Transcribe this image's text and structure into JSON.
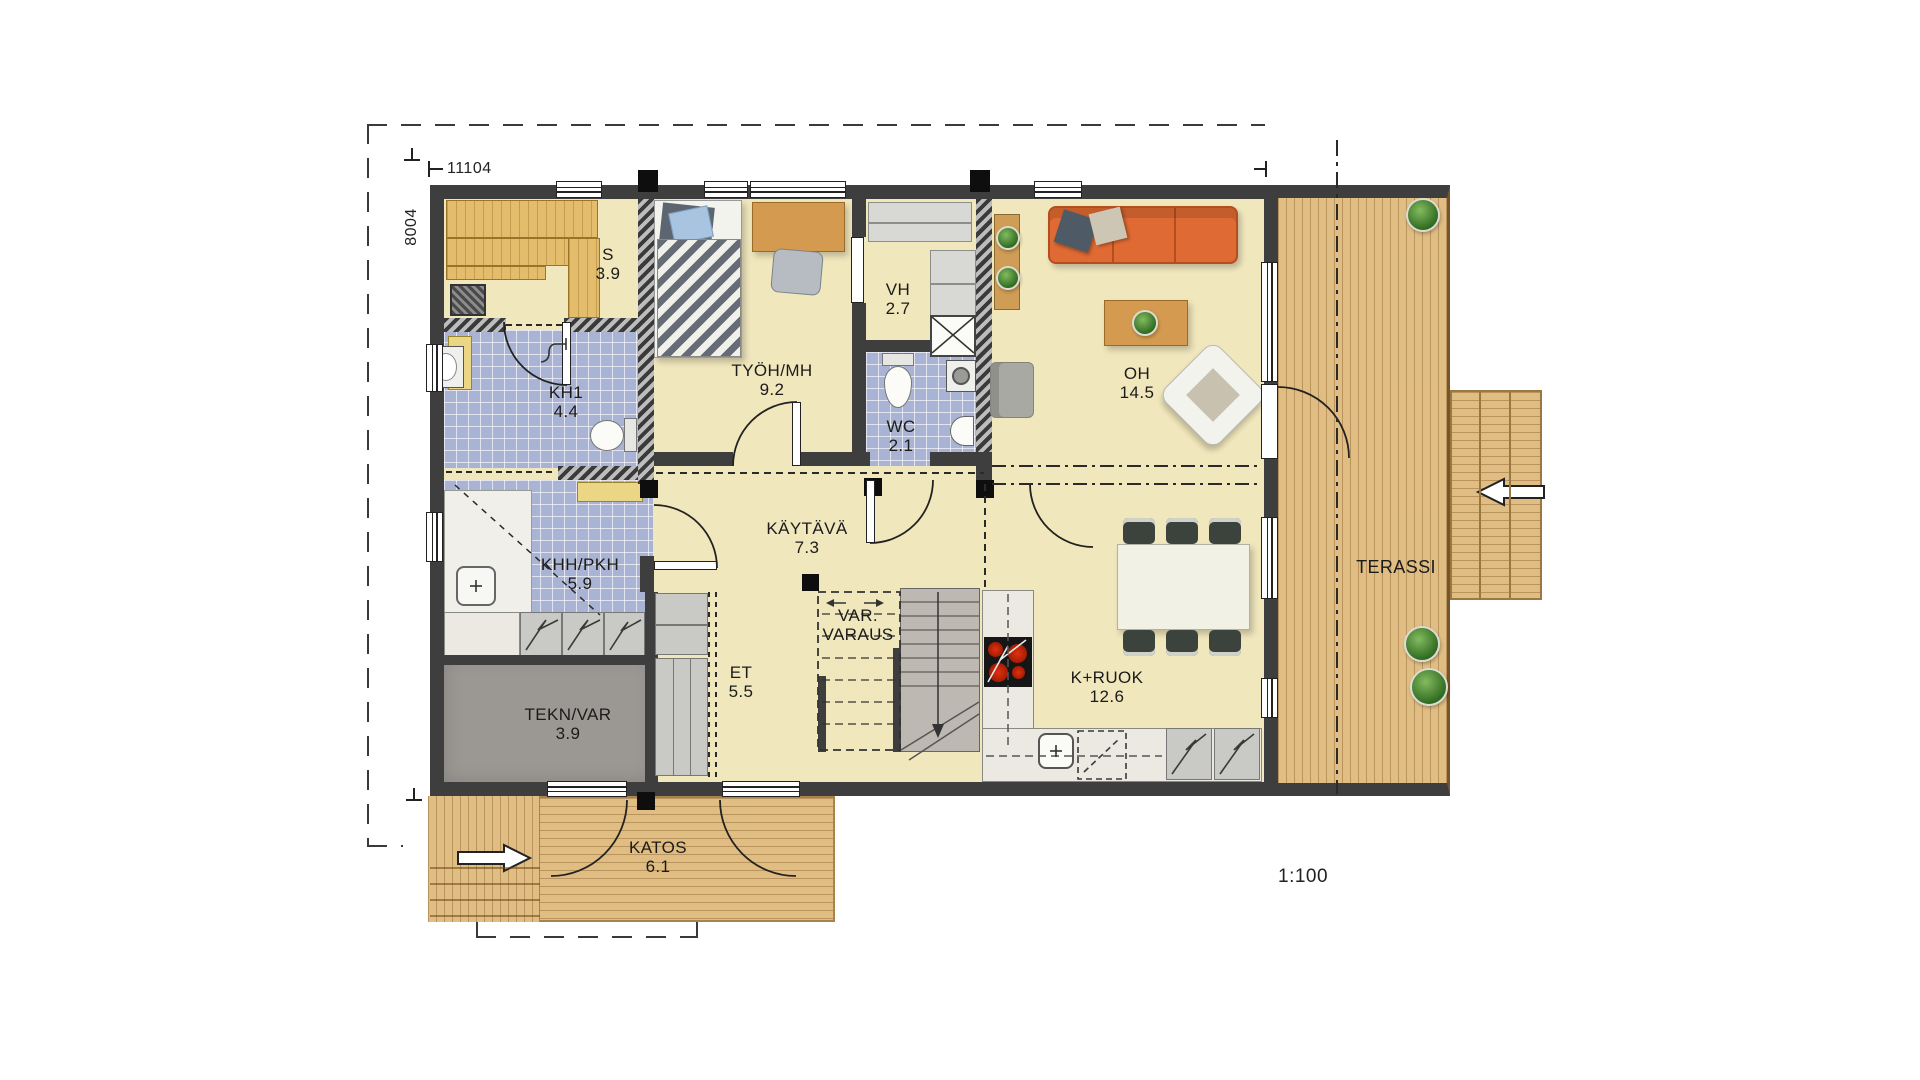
{
  "meta": {
    "scale_label": "1:100",
    "width_dim": "11104",
    "height_dim": "8004"
  },
  "rooms": [
    {
      "name": "S",
      "area": "3.9"
    },
    {
      "name": "KH1",
      "area": "4.4"
    },
    {
      "name": "TYÖH/MH",
      "area": "9.2"
    },
    {
      "name": "VH",
      "area": "2.7"
    },
    {
      "name": "WC",
      "area": "2.1"
    },
    {
      "name": "OH",
      "area": "14.5"
    },
    {
      "name": "KÄYTÄVÄ",
      "area": "7.3"
    },
    {
      "name": "KHH/PKH",
      "area": "5.9"
    },
    {
      "name": "VAR.",
      "area": "VARAUS"
    },
    {
      "name": "ET",
      "area": "5.5"
    },
    {
      "name": "TEKN/VAR",
      "area": "3.9"
    },
    {
      "name": "K+RUOK",
      "area": "12.6"
    },
    {
      "name": "KATOS",
      "area": "6.1"
    },
    {
      "name": "TERASSI",
      "area": ""
    }
  ],
  "colors": {
    "wall": "#3e3e3e",
    "floor": "#f1e7bd",
    "tile": "#a9b3d3",
    "deck": "#e0bd83",
    "sofa": "#e06a33",
    "wood": "#d49a50",
    "grayroom": "#9b9894",
    "counter": "#ebe9e2",
    "cab": "#c9c9c5",
    "bench": "#e3bd6b",
    "ybench": "#ead685",
    "stove": "#161616",
    "burner": "#c81e00"
  }
}
